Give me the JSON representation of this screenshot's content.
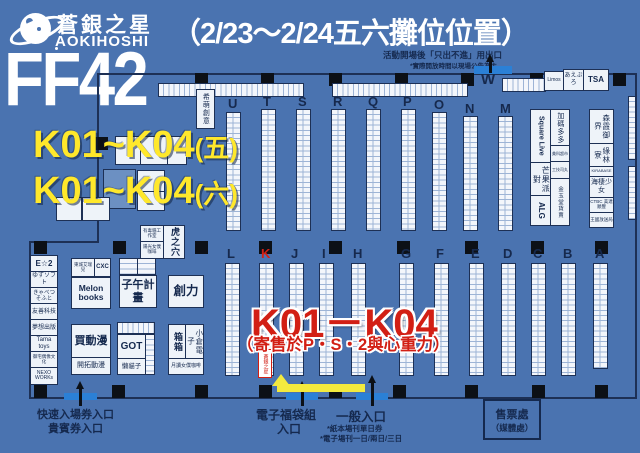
{
  "header": {
    "brand_cjk": "蒼銀之星",
    "brand_latin": "AOKIHOSHI",
    "event": "FF42",
    "title": "（2/23～2/24五六攤位位置）"
  },
  "highlight": {
    "fri_main": "K01~K04",
    "fri_suffix": "(五)",
    "sat_main": "K01~K04",
    "sat_suffix": "(六)",
    "callout": "K01－K04",
    "callout_note": "（寄售於P・S・2與心重力）",
    "booth_marker": "蒼銀之星"
  },
  "map": {
    "exit_note": "活動開場後「只出不進」用出口",
    "exit_note_sub": "*實際開放時間以現場公告為主",
    "w_label": "W",
    "upper_rows": [
      "U",
      "T",
      "S",
      "R",
      "Q",
      "P",
      "O",
      "N",
      "M"
    ],
    "lower_rows": [
      "L",
      "K",
      "J",
      "I",
      "H",
      "G",
      "F",
      "E",
      "D",
      "C",
      "B",
      "A"
    ],
    "corner_boxes": [
      "Limos",
      "あえぶろ",
      "TSA"
    ]
  },
  "booths": {
    "himoe": "希萌創意",
    "left_stack": [
      "E☆2",
      "ゆずソフト",
      "きゃべつそふと",
      "友善科技",
      "夢想出版",
      "Tama toys",
      "御宅偶像文化",
      "NEXO WORKs"
    ],
    "toxic_cat": "有毒貓工作室",
    "sunshine_maid": "陽光女僕咖啡",
    "tiger_hole": "虎之穴",
    "melon_header_a": "東城艾瑞兒",
    "melon_header_b": "CXC",
    "melon": "Melon books",
    "buy_anime": "買動漫",
    "kaitaku": "開拓動漫",
    "ziwu": "子午計畫",
    "chuangli": "創力",
    "got": "GOT",
    "lazy_cat": "懶貓子",
    "box_box": "箱箱",
    "ogura": "小倉電子",
    "tsukuyomi": "月讀女僕咖啡",
    "square_live": "Square Live",
    "mango_party": "芒果派對",
    "alg": "ALG",
    "jiama": "加碼多多",
    "tiny_a": "美科超市",
    "tiny_b": "工技司丸",
    "gold_jade": "金玉堂貨賣",
    "right_stack": [
      "森霞御界",
      "綠林寮",
      "KIRABASE",
      "海棲少女",
      "CTBC 美達順豐",
      "王國放送局"
    ]
  },
  "entrances": {
    "fast_line1": "快速入場券入口",
    "fast_line2": "貴賓券入口",
    "lucky_line1": "電子福袋組",
    "lucky_line2": "入口",
    "general": "一般入口",
    "general_note1": "*紙本場刊單日券",
    "general_note2": "*電子場刊一日/兩日/三日",
    "ticket_line1": "售票處",
    "ticket_line2": "（媒體處）"
  },
  "colors": {
    "background": "#4a73b0",
    "navy": "#15294e",
    "yellow": "#ffe82b",
    "red": "#d21f14",
    "cell_white": "#f3f6fb",
    "entrance_blue": "#2b80d6",
    "pillar_black": "#0c1016"
  }
}
